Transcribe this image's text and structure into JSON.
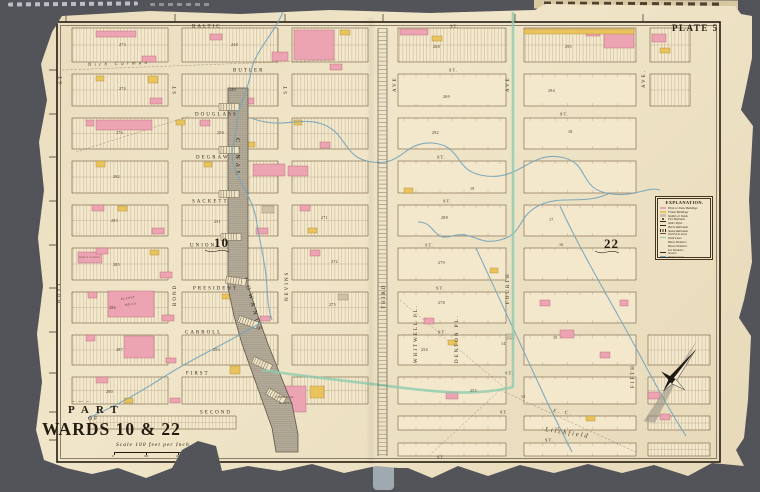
{
  "canvas": {
    "w": 760,
    "h": 492,
    "bg": "#53545A",
    "paper": "#F0E4C6"
  },
  "plate": {
    "label": "PLATE 5."
  },
  "title_block": {
    "part": "PART",
    "of": "OF",
    "wards": "WARDS 10 & 22",
    "flourish": "~ — ~",
    "scale": "Scale 100 feet per Inch",
    "scale_ticks": [
      "0",
      "100",
      "200",
      "300"
    ]
  },
  "legend": {
    "title": "EXPLANATION.",
    "items": [
      {
        "label": "Brick or Stone Buildings",
        "type": "rect",
        "color": "#EDA4B2"
      },
      {
        "label": "Frame Buildings",
        "type": "rect",
        "color": "#E9C45E"
      },
      {
        "label": "Stables or Sheds",
        "type": "rect",
        "color": "#CFC2A6"
      },
      {
        "label": "Fire Hydrants",
        "type": "dot",
        "color": "#332A1D"
      },
      {
        "label": "Water Pipes",
        "type": "line",
        "color": "#332A1D"
      },
      {
        "label": "Horse Railroads",
        "type": "dash",
        "color": "#332A1D"
      },
      {
        "label": "Steam Railroads",
        "type": "hatch",
        "color": "#332A1D"
      },
      {
        "label": "Old Farm Lines",
        "type": "dash",
        "color": "#6B5236"
      },
      {
        "label": "Ward Lines",
        "type": "line",
        "color": "#8FCBAD"
      },
      {
        "label": "Block Numbers",
        "type": "text",
        "color": "#332A1D"
      },
      {
        "label": "House Numbers",
        "type": "text",
        "color": "#332A1D"
      },
      {
        "label": "Lot Numbers",
        "type": "text",
        "color": "#332A1D"
      },
      {
        "label": "Sewers",
        "type": "dash",
        "color": "#332A1D"
      },
      {
        "label": "Watercourses",
        "type": "line",
        "color": "#74A3BA"
      }
    ]
  },
  "wards": [
    {
      "n": "10",
      "x": 214,
      "y": 247
    },
    {
      "n": "22",
      "x": 604,
      "y": 248
    }
  ],
  "streets": {
    "horizontal": [
      {
        "name": "BALTIC",
        "x": 192,
        "y": 26
      },
      {
        "name": "BUTLER",
        "x": 233,
        "y": 70
      },
      {
        "name": "DOUGLASS",
        "x": 195,
        "y": 114
      },
      {
        "name": "DEGRAW",
        "x": 196,
        "y": 157
      },
      {
        "name": "SACKETT",
        "x": 192,
        "y": 201
      },
      {
        "name": "UNION",
        "x": 190,
        "y": 245
      },
      {
        "name": "PRESIDENT",
        "x": 193,
        "y": 288
      },
      {
        "name": "CARROLL",
        "x": 185,
        "y": 332
      },
      {
        "name": "FIRST",
        "x": 186,
        "y": 373
      },
      {
        "name": "SECOND",
        "x": 200,
        "y": 412
      }
    ],
    "st_labels": [
      {
        "x": 450,
        "y": 26
      },
      {
        "x": 449,
        "y": 70
      },
      {
        "x": 560,
        "y": 114
      },
      {
        "x": 437,
        "y": 157
      },
      {
        "x": 443,
        "y": 201
      },
      {
        "x": 425,
        "y": 245
      },
      {
        "x": 436,
        "y": 288
      },
      {
        "x": 438,
        "y": 332
      },
      {
        "x": 505,
        "y": 373
      },
      {
        "x": 500,
        "y": 412
      },
      {
        "x": 545,
        "y": 440
      },
      {
        "x": 437,
        "y": 457
      }
    ],
    "vertical": [
      {
        "name": "ST",
        "x": 62,
        "y": 84
      },
      {
        "name": "HOYT",
        "x": 60,
        "y": 303
      },
      {
        "name": "ST",
        "x": 176,
        "y": 94
      },
      {
        "name": "BOND",
        "x": 176,
        "y": 306
      },
      {
        "name": "ST",
        "x": 287,
        "y": 94
      },
      {
        "name": "NEVINS",
        "x": 288,
        "y": 301
      },
      {
        "name": "AVE",
        "x": 396,
        "y": 92
      },
      {
        "name": "THIRD",
        "x": 385,
        "y": 309
      },
      {
        "name": "AVE",
        "x": 509,
        "y": 92
      },
      {
        "name": "FOURTH",
        "x": 509,
        "y": 304
      },
      {
        "name": "AVE.",
        "x": 645,
        "y": 88
      },
      {
        "name": "FIFTH",
        "x": 634,
        "y": 388
      },
      {
        "name": "WHITWELL  PL.",
        "x": 417,
        "y": 363
      },
      {
        "name": "DENTON  PL.",
        "x": 458,
        "y": 363
      }
    ]
  },
  "annotations": [
    {
      "t": "Nich Carman",
      "x": 88,
      "y": 66,
      "r": -2,
      "fs": 5,
      "ls": 3.2,
      "it": 1
    },
    {
      "t": "E. C.",
      "x": 553,
      "y": 412,
      "r": 9,
      "fs": 5,
      "ls": 2,
      "it": 1
    },
    {
      "t": "Litchfield",
      "x": 545,
      "y": 431,
      "r": 9,
      "fs": 6.5,
      "ls": 2,
      "it": 1
    },
    {
      "t": "PLANET",
      "x": 121,
      "y": 300,
      "r": -8,
      "fs": 3,
      "ls": 0.5,
      "it": 0
    },
    {
      "t": "MILLS",
      "x": 125,
      "y": 306,
      "r": -8,
      "fs": 3,
      "ls": 0.5,
      "it": 0
    },
    {
      "t": "CHEMICAL",
      "x": 275,
      "y": 398,
      "r": 0,
      "fs": 3,
      "ls": 0.5,
      "it": 0
    },
    {
      "t": "WORKS",
      "x": 279,
      "y": 404,
      "r": 0,
      "fs": 3,
      "ls": 0.5,
      "it": 0
    },
    {
      "t": "PUBLIC SCHOOL",
      "x": 79,
      "y": 258,
      "r": 0,
      "fs": 2.4,
      "ls": 0.2,
      "it": 0
    }
  ],
  "canal": {
    "label1": "CANAL",
    "label2": "GOWANUS",
    "path": "M228,88 L248,88 L248,286 L258,316 L268,344 L280,374 L292,404 L298,434 L298,452 L276,452 L272,428 L262,400 L252,372 L242,344 L234,316 L228,288 Z",
    "fill": "#B5AC9A",
    "stroke": "#5F564A"
  },
  "water": {
    "color": "#74A3BA",
    "boundary_color": "#8FCBAD",
    "creeks": [
      "M283,12 C274,34 254,52 251,72 C248,92 238,104 237,122 C236,140 229,150 234,166 C240,184 252,198 256,218 C259,236 262,250 265,268 C268,286 266,302 272,320",
      "M251,118 C282,130 300,116 322,124 C348,133 342,158 372,162 C404,166 402,142 432,143 C464,145 452,172 486,176 C520,180 530,152 560,157 C592,162 576,190 612,194 C636,197 648,186 660,190",
      "M610,193 C584,206 560,194 538,206 C516,218 524,234 500,240 C478,246 472,230 452,236 C432,242 436,222 418,222",
      "M560,206 C580,250 610,300 636,348 C652,378 668,408 686,436",
      "M476,248 C500,300 524,352 548,404 C556,420 564,436 572,452",
      "M262,322 C230,342 196,356 162,378 C134,396 112,408 88,418"
    ],
    "boundary": [
      "M513,12 L513,387",
      "M513,387 C470,398 420,390 380,385 C340,380 300,376 262,370"
    ]
  },
  "grid": {
    "border": [
      57,
      22,
      663,
      440
    ],
    "rows": [
      [
        28,
        34
      ],
      [
        74,
        32
      ],
      [
        118,
        31
      ],
      [
        161,
        32
      ],
      [
        205,
        31
      ],
      [
        248,
        32
      ],
      [
        292,
        31
      ],
      [
        335,
        30
      ],
      [
        377,
        27
      ],
      [
        416,
        14
      ],
      [
        443,
        13
      ]
    ],
    "west_cols": [
      [
        72,
        96
      ],
      [
        182,
        96
      ],
      [
        292,
        76
      ]
    ],
    "east_cols": [
      [
        398,
        108
      ],
      [
        524,
        112
      ]
    ],
    "right_col_top": [
      650,
      40
    ],
    "right_col_bottom": [
      648,
      62
    ],
    "west_extra": [
      [
        90,
        416,
        146,
        13
      ]
    ],
    "tick_rows": [
      26,
      70,
      114,
      157,
      201,
      245,
      288,
      332,
      373,
      412,
      440
    ],
    "tick_cols": [
      66,
      175,
      285,
      383,
      515,
      643
    ]
  },
  "railroad": {
    "x1": 378,
    "x2": 387,
    "y1": 28,
    "y2": 456
  },
  "farm_lines": [
    [
      62,
      70,
      335,
      60
    ],
    [
      76,
      152,
      190,
      116
    ],
    [
      500,
      390,
      636,
      452
    ],
    [
      500,
      390,
      430,
      455
    ],
    [
      400,
      300,
      505,
      388
    ]
  ],
  "bridges": [
    {
      "x": 229,
      "y": 107,
      "r": 0
    },
    {
      "x": 229,
      "y": 150,
      "r": 0
    },
    {
      "x": 229,
      "y": 194,
      "r": 0
    },
    {
      "x": 231,
      "y": 237,
      "r": 0
    },
    {
      "x": 236,
      "y": 281,
      "r": 8
    },
    {
      "x": 248,
      "y": 322,
      "r": 20
    },
    {
      "x": 262,
      "y": 364,
      "r": 25
    },
    {
      "x": 276,
      "y": 396,
      "r": 30
    }
  ],
  "buildings": {
    "pink": [
      [
        294,
        30,
        40,
        30
      ],
      [
        272,
        52,
        16,
        9
      ],
      [
        96,
        120,
        56,
        10
      ],
      [
        253,
        164,
        32,
        12
      ],
      [
        288,
        166,
        20,
        10
      ],
      [
        108,
        291,
        46,
        26
      ],
      [
        124,
        336,
        30,
        22
      ],
      [
        78,
        252,
        24,
        11
      ],
      [
        268,
        386,
        38,
        26
      ],
      [
        604,
        30,
        30,
        18
      ],
      [
        400,
        29,
        28,
        6
      ],
      [
        96,
        31,
        40,
        6
      ],
      [
        142,
        56,
        14,
        6
      ],
      [
        210,
        34,
        12,
        6
      ],
      [
        330,
        64,
        12,
        6
      ],
      [
        150,
        98,
        12,
        6
      ],
      [
        240,
        98,
        14,
        6
      ],
      [
        86,
        120,
        8,
        6
      ],
      [
        200,
        120,
        10,
        6
      ],
      [
        320,
        142,
        10,
        6
      ],
      [
        92,
        205,
        12,
        6
      ],
      [
        152,
        228,
        12,
        6
      ],
      [
        256,
        228,
        12,
        6
      ],
      [
        300,
        205,
        10,
        6
      ],
      [
        96,
        248,
        12,
        6
      ],
      [
        160,
        272,
        12,
        6
      ],
      [
        310,
        250,
        10,
        6
      ],
      [
        88,
        292,
        9,
        6
      ],
      [
        162,
        315,
        12,
        6
      ],
      [
        260,
        316,
        10,
        5
      ],
      [
        86,
        335,
        9,
        6
      ],
      [
        166,
        358,
        10,
        5
      ],
      [
        96,
        377,
        12,
        6
      ],
      [
        170,
        398,
        10,
        5
      ],
      [
        424,
        318,
        10,
        6
      ],
      [
        560,
        330,
        14,
        8
      ],
      [
        600,
        352,
        10,
        6
      ],
      [
        446,
        392,
        12,
        7
      ],
      [
        586,
        30,
        14,
        6
      ],
      [
        648,
        392,
        12,
        7
      ],
      [
        660,
        414,
        10,
        6
      ],
      [
        540,
        300,
        10,
        6
      ],
      [
        620,
        300,
        8,
        6
      ],
      [
        652,
        34,
        14,
        8
      ]
    ],
    "yellow": [
      [
        148,
        76,
        10,
        7
      ],
      [
        96,
        161,
        9,
        6
      ],
      [
        230,
        366,
        10,
        8
      ],
      [
        310,
        386,
        14,
        12
      ],
      [
        404,
        188,
        9,
        5
      ],
      [
        490,
        268,
        8,
        5
      ],
      [
        524,
        29,
        110,
        5
      ],
      [
        432,
        36,
        10,
        5
      ],
      [
        118,
        206,
        9,
        5
      ],
      [
        176,
        120,
        9,
        5
      ],
      [
        246,
        142,
        9,
        5
      ],
      [
        308,
        228,
        9,
        5
      ],
      [
        150,
        250,
        9,
        5
      ],
      [
        222,
        294,
        9,
        5
      ],
      [
        124,
        398,
        9,
        5
      ],
      [
        448,
        340,
        9,
        5
      ],
      [
        586,
        416,
        9,
        5
      ],
      [
        96,
        76,
        8,
        5
      ],
      [
        294,
        120,
        8,
        5
      ],
      [
        204,
        162,
        8,
        5
      ],
      [
        340,
        30,
        10,
        5
      ],
      [
        660,
        48,
        10,
        5
      ]
    ],
    "gray": [
      [
        262,
        206,
        12,
        7
      ],
      [
        338,
        294,
        10,
        6
      ],
      [
        506,
        334,
        8,
        5
      ]
    ],
    "pink_color": "#EDA4B2",
    "yellow_color": "#E9C45E",
    "gray_color": "#CFC2A6"
  },
  "block_numbers": [
    {
      "t": "268",
      "x": 433,
      "y": 48
    },
    {
      "t": "269",
      "x": 443,
      "y": 98
    },
    {
      "t": "292",
      "x": 432,
      "y": 134
    },
    {
      "t": "288",
      "x": 441,
      "y": 219
    },
    {
      "t": "279",
      "x": 438,
      "y": 264
    },
    {
      "t": "278",
      "x": 438,
      "y": 304
    },
    {
      "t": "271",
      "x": 321,
      "y": 219
    },
    {
      "t": "272",
      "x": 331,
      "y": 263
    },
    {
      "t": "275",
      "x": 329,
      "y": 306
    },
    {
      "t": "273",
      "x": 119,
      "y": 46
    },
    {
      "t": "274",
      "x": 119,
      "y": 90
    },
    {
      "t": "276",
      "x": 116,
      "y": 134
    },
    {
      "t": "282",
      "x": 113,
      "y": 178
    },
    {
      "t": "283",
      "x": 111,
      "y": 222
    },
    {
      "t": "285",
      "x": 113,
      "y": 266
    },
    {
      "t": "286",
      "x": 109,
      "y": 309
    },
    {
      "t": "287",
      "x": 116,
      "y": 351
    },
    {
      "t": "280",
      "x": 106,
      "y": 393
    },
    {
      "t": "248",
      "x": 231,
      "y": 46
    },
    {
      "t": "249",
      "x": 229,
      "y": 91
    },
    {
      "t": "250",
      "x": 217,
      "y": 134
    },
    {
      "t": "251",
      "x": 214,
      "y": 223
    },
    {
      "t": "253",
      "x": 213,
      "y": 351
    },
    {
      "t": "254",
      "x": 421,
      "y": 351
    },
    {
      "t": "255",
      "x": 470,
      "y": 392
    },
    {
      "t": "295",
      "x": 565,
      "y": 48
    },
    {
      "t": "294",
      "x": 548,
      "y": 92
    },
    {
      "t": "19",
      "x": 470,
      "y": 190
    },
    {
      "t": "18",
      "x": 568,
      "y": 133
    },
    {
      "t": "17",
      "x": 549,
      "y": 221
    },
    {
      "t": "16",
      "x": 559,
      "y": 246
    },
    {
      "t": "15",
      "x": 553,
      "y": 339
    },
    {
      "t": "14",
      "x": 501,
      "y": 345
    },
    {
      "t": "13",
      "x": 521,
      "y": 398
    },
    {
      "t": "12",
      "x": 555,
      "y": 430
    }
  ],
  "compass": {
    "x": 672,
    "y": 380,
    "rot": 38
  }
}
